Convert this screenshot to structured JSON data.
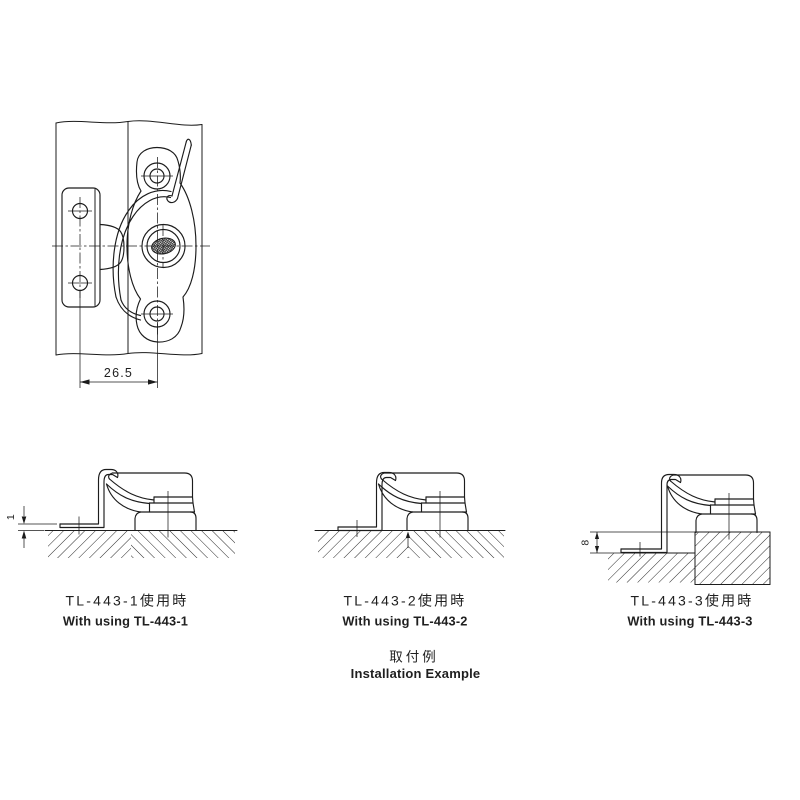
{
  "colors": {
    "background": "#ffffff",
    "line": "#1c1c1c",
    "text": "#1f1f1f"
  },
  "main_view": {
    "dimension_label": "26.5"
  },
  "sections": [
    {
      "title_ja": "TL-443-1使用時",
      "title_en": "With using TL-443-1",
      "dimension_label": "1"
    },
    {
      "title_ja": "TL-443-2使用時",
      "title_en": "With using TL-443-2"
    },
    {
      "title_ja": "TL-443-3使用時",
      "title_en": "With using TL-443-3",
      "dimension_label": "8"
    }
  ],
  "footer": {
    "title_ja": "取付例",
    "title_en": "Installation Example"
  }
}
